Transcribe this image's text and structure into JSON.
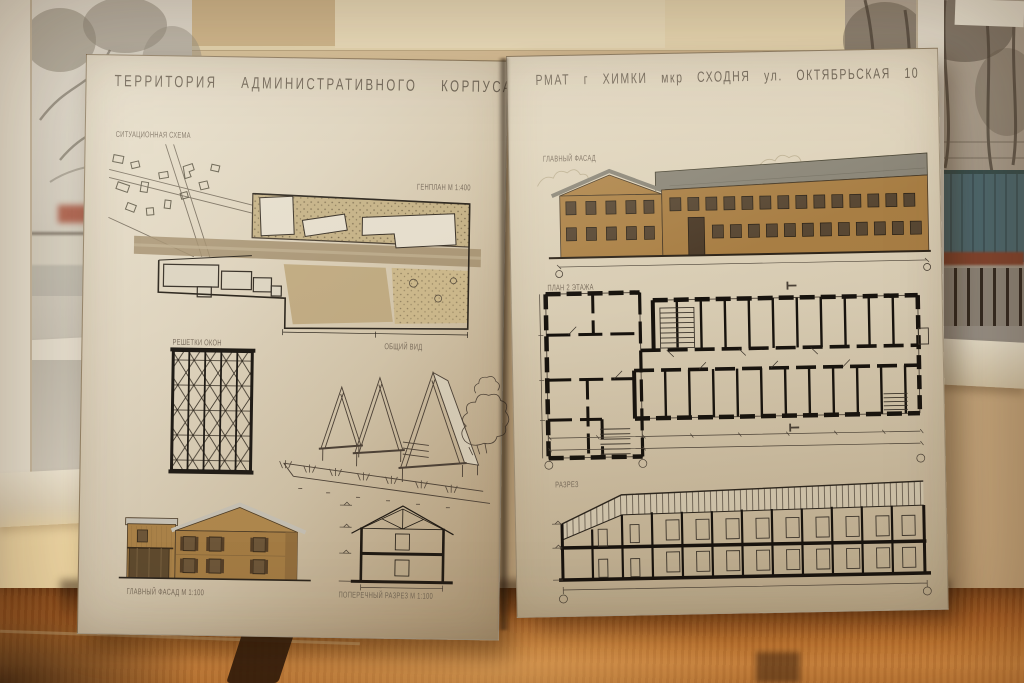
{
  "boards": {
    "left": {
      "title": "ТЕРРИТОРИЯ АДМИНИСТРАТИВНОГО КОРПУСА",
      "situational_scheme_label": "СИТУАЦИОННАЯ СХЕМА",
      "genplan_label": "ГЕНПЛАН М 1:400",
      "grille_label": "РЕШЕТКИ ОКОН",
      "perspective_label": "ОБЩИЙ ВИД",
      "facade_label": "ГЛАВНЫЙ ФАСАД М 1:100",
      "section_label": "ПОПЕРЕЧНЫЙ РАЗРЕЗ М 1:100"
    },
    "right": {
      "title": "РМАТ г ХИМКИ мкр СХОДНЯ ул. ОКТЯБРЬСКАЯ 10",
      "elevation_label": "ГЛАВНЫЙ ФАСАД",
      "plan_label": "ПЛАН 2 ЭТАЖА",
      "section_label": "РАЗРЕЗ"
    }
  },
  "colors": {
    "wall_beige": "#d9c29a",
    "paper": "#d8cdb7",
    "pencil_ink": "#3c332a",
    "building_ochre": "#a87e44",
    "roof_gray": "#8a8577",
    "table_wood": "#b06a2a",
    "distant_building_teal": "#4e6a70"
  }
}
